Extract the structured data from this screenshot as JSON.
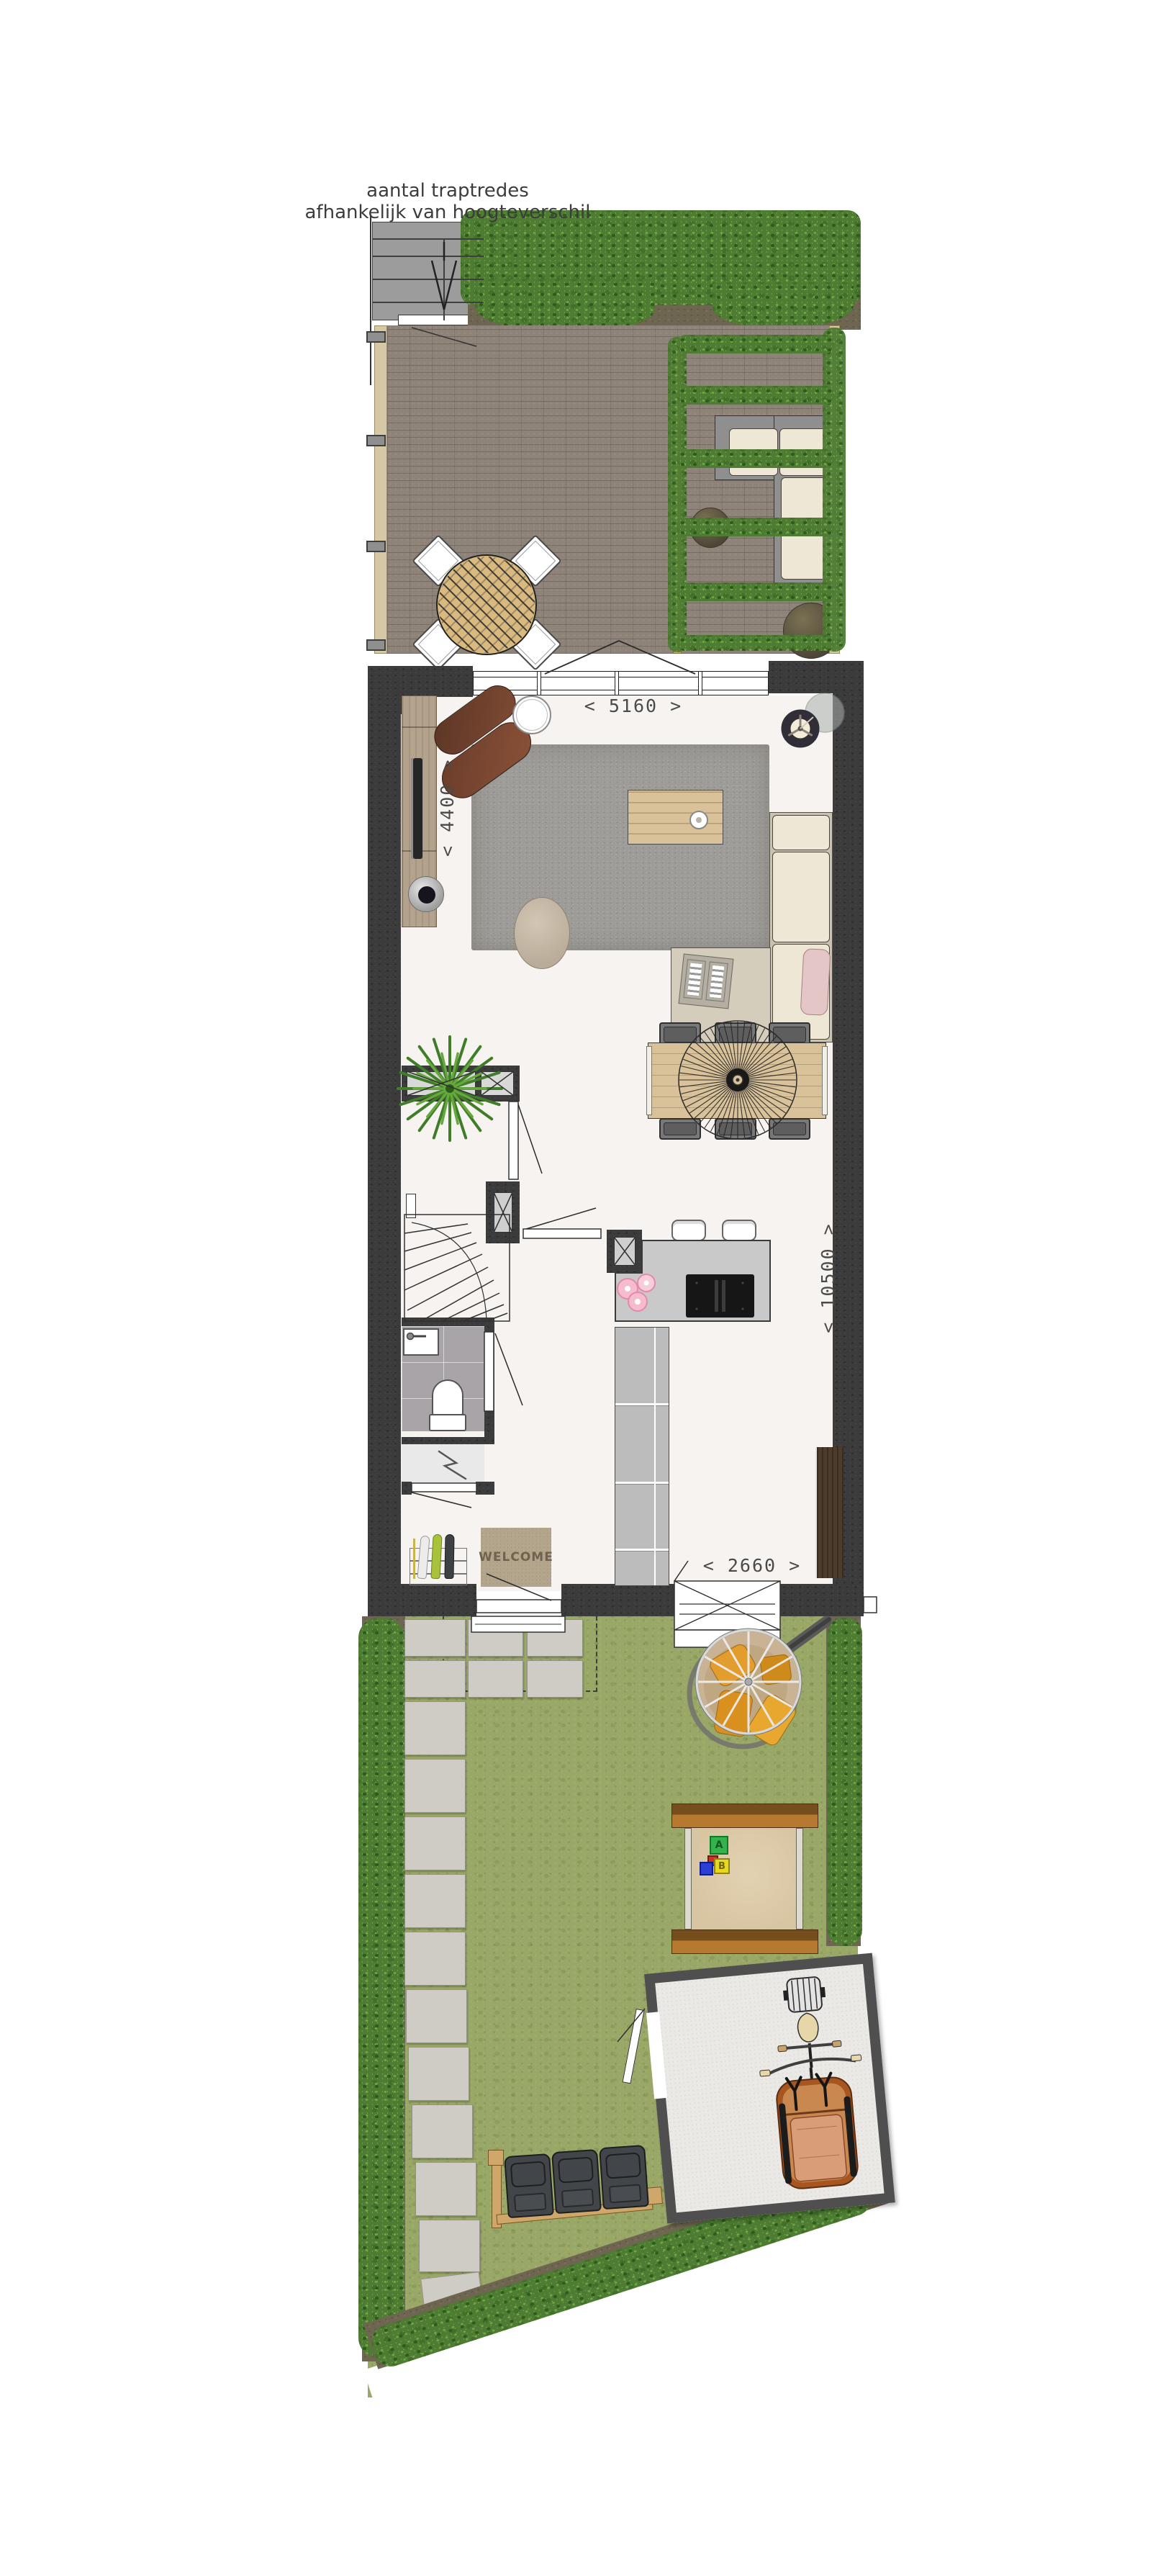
{
  "note": {
    "line1": "aantal traptredes",
    "line2": "afhankelijk van hoogteverschil"
  },
  "dimensions": {
    "rear_width": "< 5160 >",
    "living_width": "< 4400 >",
    "depth": "< 10500 >",
    "front_width": "< 2660 >"
  },
  "doormat": {
    "text": "WELCOME"
  },
  "sandbox": {
    "block_a": "A",
    "block_b": "B"
  },
  "colors": {
    "wall": "#3b3b3b",
    "floor": "#f7f3f0",
    "brick": "#8e8379",
    "grass": "#9aa867",
    "hedge": "#578539",
    "soil": "#6f6651",
    "beam_wood": "#d6c7a5",
    "pergola_wood": "#cfa86b",
    "table_wood": "#d9b97e",
    "dining_wood": "#d9c29a",
    "counter": "#c9c9c9",
    "hob": "#161616",
    "sofa_cushion": "#eee7d6",
    "sofa_frame": "#8f8f8f",
    "sofa_chaise": "#d5cdbb",
    "rug": "#9e9c98",
    "leather": "#74442f",
    "mat": "#b3a58c",
    "mat_text": "#6f6350",
    "slab": "#cfccc6",
    "shed_wall": "#4f4f4f",
    "shed_floor": "#ebe9e5",
    "bin": "#42464a",
    "bin_frame": "#cfa76a",
    "cushion_orange": "#e09b2d",
    "tile": "#a8a4a8",
    "cabinet": "#bcbcbc",
    "cabinet_brown": "#4d3b2b",
    "sand": "#d8c5a2",
    "pink_pillow": "#e5c6c6",
    "dim_text": "#4a4a4a",
    "ink": "#2e2e2e"
  }
}
